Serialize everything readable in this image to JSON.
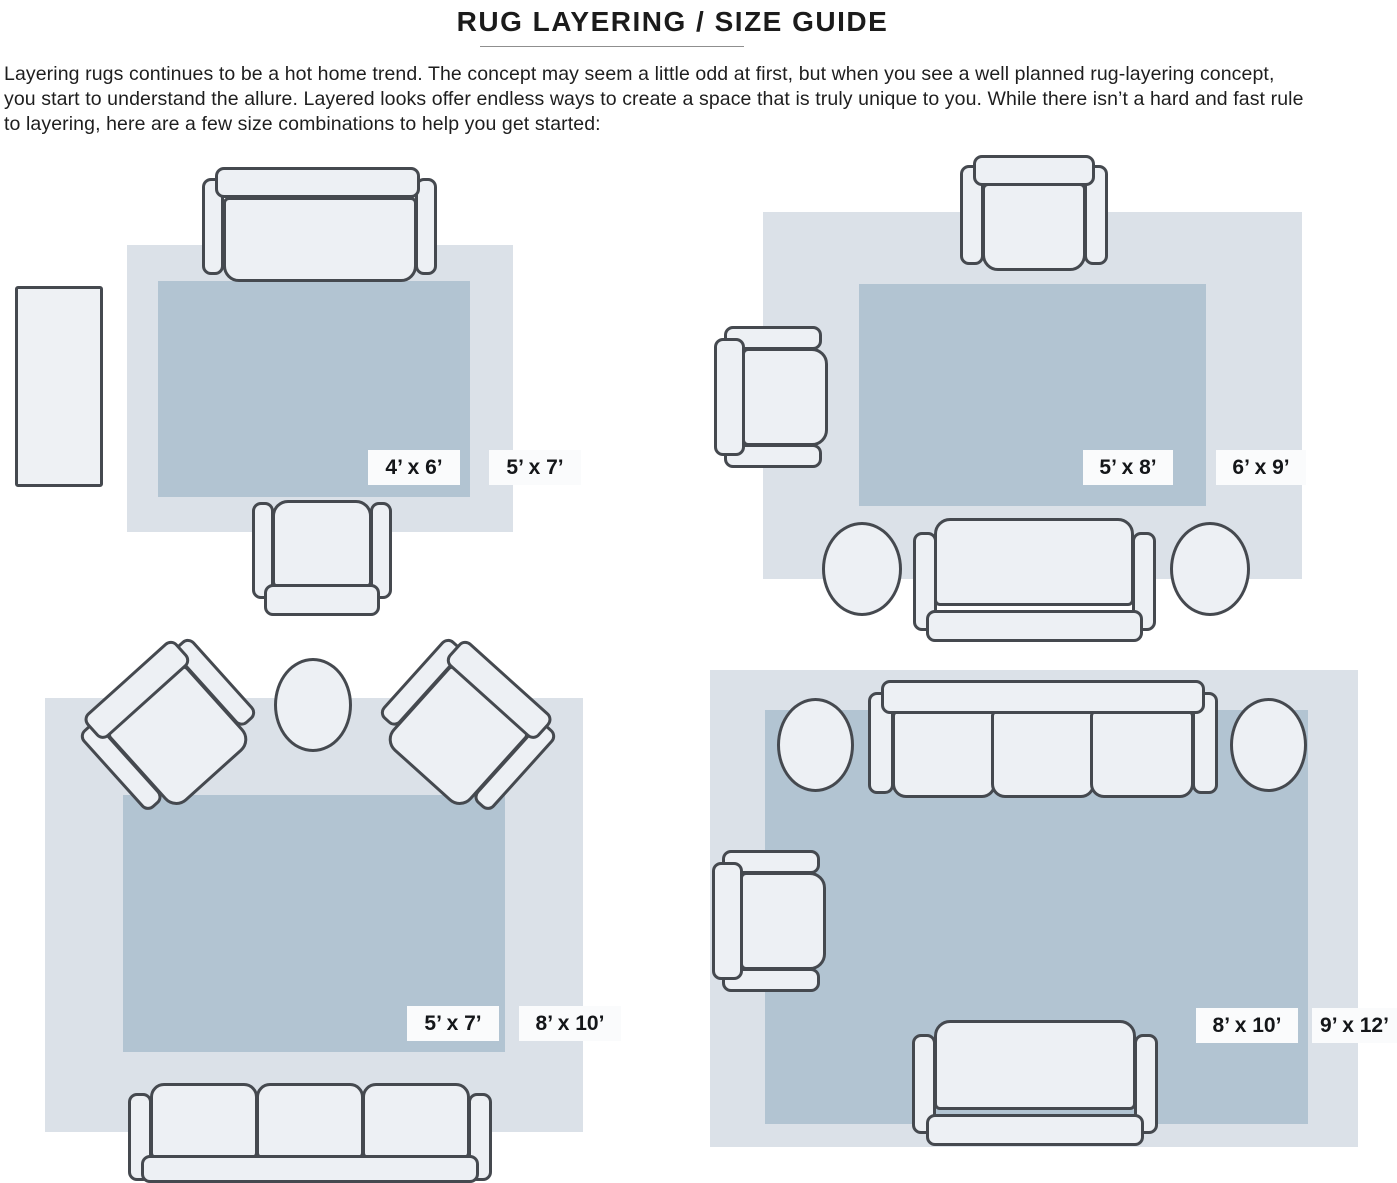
{
  "title": "RUG LAYERING / SIZE GUIDE",
  "intro_lines": [
    "Layering rugs continues to be a hot home trend. The concept may seem a little odd at first, but when you see a well planned rug-layering concept,",
    "you start to understand the allure. Layered looks offer endless ways to create a space that is truly unique to you. While there isn’t a hard and fast rule",
    "to layering, here are a few size combinations to help you get started:"
  ],
  "diagrams": [
    {
      "name": "sofa-chair-and-side-table",
      "inner_rug_size": "4’ x 6’",
      "outer_rug_size": "5’ x 7’"
    },
    {
      "name": "two-chairs-sofa-two-round-tables",
      "inner_rug_size": "5’ x 8’",
      "outer_rug_size": "6’ x 9’"
    },
    {
      "name": "angled-chairs-round-table-sofa",
      "inner_rug_size": "5’ x 7’",
      "outer_rug_size": "8’ x 10’"
    },
    {
      "name": "large-sofa-loveseat-chair-round-tables",
      "inner_rug_size": "8’ x 10’",
      "outer_rug_size": "9’ x 12’"
    }
  ],
  "colors": {
    "outer_rug": "#dbe1e8",
    "inner_rug": "#b2c4d2",
    "furniture_fill": "#edf0f4",
    "furniture_outline": "#45494f",
    "label_background": "#fafbfc",
    "label_text": "#141619",
    "title_text": "#1b1b1b",
    "body_text": "#1e1e1e"
  }
}
